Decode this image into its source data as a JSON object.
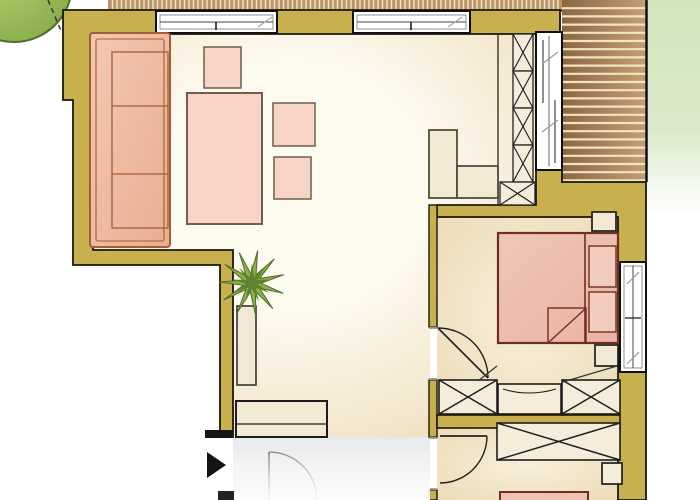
{
  "meta": {
    "type": "floor-plan",
    "rooms": [
      "living-room",
      "bedroom",
      "second-room",
      "entrance-hall",
      "balcony-terrace"
    ]
  },
  "palette": {
    "wall": "#c7b04d",
    "wallStroke": "#1b170a",
    "stripPlank": "#bd9468",
    "stripGap": "#f2e5cc",
    "deckGap": "#f2e3c6",
    "deckA": "#8a6642",
    "deckB": "#c79e72",
    "floorLight": "#fdfaf0",
    "floorWarm": "#efdebd",
    "bedFloorLight": "#f8efda",
    "bedFloorWarm": "#ecdbb8",
    "hallA": "#e8eaec",
    "hallB": "#f4f5f6",
    "sofaA": "#f3c9b4",
    "sofaB": "#e9ad90",
    "sofaStroke": "#a55d35",
    "tableFill": "#f7d4c5",
    "tableStroke": "#6e5e4b",
    "cabFill": "#f2e9d5",
    "cabStroke": "#514b3b",
    "wardrobeFill": "#f5edd9",
    "bedA": "#f0c6b9",
    "bedB": "#e9b3a3",
    "bedFill": "#edc1b4",
    "bedStroke": "#6f2f1f",
    "pillow": "#f3ccc0",
    "doorGray": "#8a8a8a",
    "jambGray": "#8f8f8f",
    "gardenGreen": "#cfe3b9",
    "treeA": "#b3cf6d",
    "treeB": "#86a948",
    "treeStroke": "#4f6c28",
    "green1": "#8cb04b",
    "green2": "#5d8430"
  },
  "elements": [
    {
      "t": "rect",
      "n": "garden-green",
      "x": 647,
      "y": 0,
      "w": 53,
      "h": 215,
      "f": "url(#gGreen)"
    },
    {
      "t": "circle",
      "n": "tree-canopy",
      "cx": 14,
      "cy": -16,
      "r": 58,
      "f": "url(#gTree)",
      "s": "$treeStroke",
      "sw": 2
    },
    {
      "t": "line",
      "n": "roof-overhang-dashed-line",
      "x1": 48,
      "y1": 0,
      "x2": 62,
      "y2": 33,
      "s": "#333333",
      "sw": 1.5,
      "dash": "5,4"
    },
    {
      "t": "poly",
      "n": "living-room-floor",
      "pts": "93,34 536,34 536,205 430,205 430,437 233,437 233,250 93,250",
      "f": "url(#gFloorLiving)"
    },
    {
      "t": "rect",
      "n": "bedroom-floor",
      "x": 437,
      "y": 217,
      "w": 181,
      "h": 198,
      "f": "url(#gFloorBed)"
    },
    {
      "t": "rect",
      "n": "second-room-floor",
      "x": 437,
      "y": 428,
      "w": 181,
      "h": 72,
      "f": "url(#gFloorBed)"
    },
    {
      "t": "rect",
      "n": "entrance-hall-floor",
      "x": 233,
      "y": 437,
      "w": 197,
      "h": 63,
      "f": "url(#gHall)"
    },
    {
      "t": "vstripes",
      "n": "terrace-deck-strip",
      "x": 108,
      "y": 0,
      "w": 454,
      "h": 10,
      "step": 4.5,
      "f": "$stripPlank",
      "gap": "$stripGap",
      "gsw": 1.4
    },
    {
      "t": "line",
      "n": "deck-strip-edge",
      "x1": 108,
      "y1": 10.8,
      "x2": 562,
      "y2": 10.8,
      "s": "#1c1c14",
      "sw": 1.6
    },
    {
      "t": "hstripes",
      "n": "balcony-deck",
      "x": 562,
      "y": 0,
      "w": 84,
      "h": 182,
      "step": 8.2,
      "f": "url(#gDeck)",
      "gap": "$deckGap",
      "gsw": 2.2
    },
    {
      "t": "line",
      "n": "balcony-edge-right",
      "x1": 646.5,
      "y1": 0,
      "x2": 646.5,
      "y2": 182,
      "s": "#111111",
      "sw": 2.5
    },
    {
      "t": "line",
      "n": "balcony-edge-bottom",
      "x1": 562,
      "y1": 182.5,
      "x2": 646,
      "y2": 182.5,
      "s": "#111111",
      "sw": 2
    },
    {
      "t": "poly",
      "n": "outer-wall-left",
      "pts": "63,10 560,10 560,34 93,34 93,250 233,250 233,437 220,437 220,265 73,265 73,100 63,100",
      "f": "$wall",
      "s": "$wallStroke",
      "sw": 1.8
    },
    {
      "t": "poly",
      "n": "outer-wall-right",
      "pts": "536,170 562,170 562,182 646,182 646,500 618,500 618,217 437,217 437,205 536,205",
      "f": "$wall",
      "s": "$wallStroke",
      "sw": 1.8
    },
    {
      "t": "rect",
      "n": "partition-wall-upper",
      "x": 429,
      "y": 205,
      "w": 8,
      "h": 122,
      "f": "$wall",
      "s": "$wallStroke",
      "sw": 1.4
    },
    {
      "t": "rect",
      "n": "partition-wall-mid",
      "x": 429,
      "y": 380,
      "w": 8,
      "h": 57,
      "f": "$wall",
      "s": "$wallStroke",
      "sw": 1.4
    },
    {
      "t": "rect",
      "n": "partition-wall-lower",
      "x": 429,
      "y": 490,
      "w": 8,
      "h": 10,
      "f": "$wall",
      "s": "$wallStroke",
      "sw": 1.4
    },
    {
      "t": "rect",
      "n": "bedrooms-divider-wall",
      "x": 437,
      "y": 415,
      "w": 183,
      "h": 13,
      "f": "$wall",
      "s": "$wallStroke",
      "sw": 1.6
    },
    {
      "t": "rect",
      "n": "wall-end-cap",
      "x": 205,
      "y": 430,
      "w": 28,
      "h": 8,
      "f": "#161616"
    },
    {
      "t": "line",
      "n": "door-jamb-1",
      "x1": 429,
      "y1": 327.8,
      "x2": 437,
      "y2": 327.8,
      "s": "$jambGray",
      "sw": 2
    },
    {
      "t": "line",
      "n": "door-jamb-2",
      "x1": 429,
      "y1": 379.2,
      "x2": 437,
      "y2": 379.2,
      "s": "$jambGray",
      "sw": 2
    },
    {
      "t": "line",
      "n": "door-jamb-3",
      "x1": 429,
      "y1": 437.8,
      "x2": 437,
      "y2": 437.8,
      "s": "$jambGray",
      "sw": 2
    },
    {
      "t": "line",
      "n": "door-jamb-4",
      "x1": 429,
      "y1": 489.2,
      "x2": 437,
      "y2": 489.2,
      "s": "$jambGray",
      "sw": 2
    },
    {
      "t": "line",
      "n": "column-guide-line",
      "x1": 498,
      "y1": 34,
      "x2": 498,
      "y2": 205,
      "s": "#3a3428",
      "sw": 1.4
    },
    {
      "t": "xbox",
      "n": "shelf-column-cell-1",
      "x": 513,
      "y": 34,
      "w": 20,
      "h": 37,
      "f": "$wardrobeFill",
      "s": "#222222",
      "sw": 1.3
    },
    {
      "t": "xbox",
      "n": "shelf-column-cell-2",
      "x": 513,
      "y": 71,
      "w": 20,
      "h": 37,
      "f": "$wardrobeFill",
      "s": "#222222",
      "sw": 1.3
    },
    {
      "t": "xbox",
      "n": "shelf-column-cell-3",
      "x": 513,
      "y": 108,
      "w": 20,
      "h": 37,
      "f": "$wardrobeFill",
      "s": "#222222",
      "sw": 1.3
    },
    {
      "t": "xbox",
      "n": "shelf-column-cell-4",
      "x": 513,
      "y": 145,
      "w": 20,
      "h": 37,
      "f": "$wardrobeFill",
      "s": "#222222",
      "sw": 1.3
    },
    {
      "t": "xbox",
      "n": "shelf-column-base",
      "x": 500,
      "y": 182,
      "w": 35,
      "h": 23,
      "f": "$wardrobeFill",
      "s": "#222222",
      "sw": 1.3
    },
    {
      "t": "rect",
      "n": "balcony-sliding-door",
      "x": 536,
      "y": 32,
      "w": 26,
      "h": 138,
      "f": "#ffffff",
      "s": "#101010",
      "sw": 2
    },
    {
      "t": "line",
      "n": "sliding-door-rail",
      "x1": 549,
      "y1": 36,
      "x2": 549,
      "y2": 166,
      "s": "#666666",
      "sw": 1
    },
    {
      "t": "line",
      "n": "sliding-panel-1",
      "x1": 543,
      "y1": 40,
      "x2": 543,
      "y2": 103,
      "s": "#444444",
      "sw": 1.2
    },
    {
      "t": "line",
      "n": "sliding-panel-2",
      "x1": 555,
      "y1": 100,
      "x2": 555,
      "y2": 163,
      "s": "#444444",
      "sw": 1.2
    },
    {
      "t": "line",
      "n": "slide-arrow-1",
      "x1": 558,
      "y1": 52,
      "x2": 542,
      "y2": 64,
      "s": "#999999",
      "sw": 1.2
    },
    {
      "t": "line",
      "n": "slide-arrow-2",
      "x1": 558,
      "y1": 120,
      "x2": 542,
      "y2": 132,
      "s": "#999999",
      "sw": 1.2
    },
    {
      "t": "rect",
      "n": "window-1",
      "x": 156,
      "y": 11,
      "w": 121,
      "h": 22,
      "f": "#ffffff",
      "s": "#101010",
      "sw": 2
    },
    {
      "t": "rect",
      "n": "window-1-inner",
      "x": 160,
      "y": 15,
      "w": 113,
      "h": 14,
      "f": "none",
      "s": "#777777",
      "sw": 0.8
    },
    {
      "t": "line",
      "n": "window-1-mid",
      "x1": 160,
      "y1": 22,
      "x2": 273,
      "y2": 22,
      "s": "#444444",
      "sw": 1
    },
    {
      "t": "line",
      "n": "window-1-tick",
      "x1": 216,
      "y1": 22,
      "x2": 216,
      "y2": 30,
      "s": "#111111",
      "sw": 1.5
    },
    {
      "t": "line",
      "n": "window-1-arrow",
      "x1": 258,
      "y1": 27,
      "x2": 272,
      "y2": 17,
      "s": "#aaaaaa",
      "sw": 1.2
    },
    {
      "t": "rect",
      "n": "window-2",
      "x": 353,
      "y": 11,
      "w": 117,
      "h": 22,
      "f": "#ffffff",
      "s": "#101010",
      "sw": 2
    },
    {
      "t": "rect",
      "n": "window-2-inner",
      "x": 357,
      "y": 15,
      "w": 109,
      "h": 14,
      "f": "none",
      "s": "#777777",
      "sw": 0.8
    },
    {
      "t": "line",
      "n": "window-2-mid",
      "x1": 357,
      "y1": 22,
      "x2": 466,
      "y2": 22,
      "s": "#444444",
      "sw": 1
    },
    {
      "t": "line",
      "n": "window-2-tick",
      "x1": 411,
      "y1": 22,
      "x2": 411,
      "y2": 30,
      "s": "#111111",
      "sw": 1.5
    },
    {
      "t": "line",
      "n": "window-2-arrow",
      "x1": 448,
      "y1": 27,
      "x2": 462,
      "y2": 17,
      "s": "#aaaaaa",
      "sw": 1.2
    },
    {
      "t": "rect",
      "n": "sofa",
      "x": 90,
      "y": 33,
      "w": 80,
      "h": 214,
      "rx": 3,
      "f": "url(#gSofa)",
      "s": "$sofaStroke",
      "sw": 2
    },
    {
      "t": "rect",
      "n": "sofa-inner-frame",
      "x": 96,
      "y": 39,
      "w": 68,
      "h": 202,
      "rx": 2,
      "f": "none",
      "s": "$sofaStroke",
      "sw": 1.1
    },
    {
      "t": "rect",
      "n": "sofa-cushions",
      "x": 112,
      "y": 52,
      "w": 56,
      "h": 176,
      "f": "none",
      "s": "$sofaStroke",
      "sw": 1.3
    },
    {
      "t": "line",
      "n": "sofa-cushion-divider-1",
      "x1": 112,
      "y1": 106,
      "x2": 168,
      "y2": 106,
      "s": "$sofaStroke",
      "sw": 1.3
    },
    {
      "t": "line",
      "n": "sofa-cushion-divider-2",
      "x1": 112,
      "y1": 174,
      "x2": 168,
      "y2": 174,
      "s": "$sofaStroke",
      "sw": 1.3
    },
    {
      "t": "rect",
      "n": "dining-table",
      "x": 187,
      "y": 93,
      "w": 75,
      "h": 131,
      "f": "$tableFill",
      "s": "$tableStroke",
      "sw": 2
    },
    {
      "t": "rect",
      "n": "chair-top",
      "x": 204,
      "y": 47,
      "w": 37,
      "h": 41,
      "f": "$tableFill",
      "s": "$tableStroke",
      "sw": 1.5
    },
    {
      "t": "rect",
      "n": "chair-right-1",
      "x": 273,
      "y": 103,
      "w": 42,
      "h": 43,
      "f": "$tableFill",
      "s": "$tableStroke",
      "sw": 1.5
    },
    {
      "t": "rect",
      "n": "chair-right-2",
      "x": 274,
      "y": 157,
      "w": 37,
      "h": 42,
      "f": "$tableFill",
      "s": "$tableStroke",
      "sw": 1.5
    },
    {
      "t": "rect",
      "n": "plant-pot",
      "x": 237,
      "y": 306,
      "w": 19,
      "h": 79,
      "f": "$cabFill",
      "s": "#333333",
      "sw": 1.6
    },
    {
      "t": "star",
      "n": "plant-leaves-outer",
      "cx": 252,
      "cy": 283,
      "ro": 33,
      "ri": 9,
      "npts": 11,
      "rot": 10,
      "f": "$green1",
      "s": "$treeStroke",
      "sw": 1
    },
    {
      "t": "star",
      "n": "plant-leaves-inner",
      "cx": 252,
      "cy": 283,
      "ro": 20,
      "ri": 6,
      "npts": 9,
      "rot": 40,
      "f": "$green2"
    },
    {
      "t": "rect",
      "n": "entry-bench",
      "x": 236,
      "y": 401,
      "w": 91,
      "h": 36,
      "f": "$cabFill",
      "s": "#1d1d1d",
      "sw": 2
    },
    {
      "t": "line",
      "n": "entry-bench-edge",
      "x1": 237,
      "y1": 424,
      "x2": 326,
      "y2": 424,
      "s": "#1d1d1d",
      "sw": 1.2
    },
    {
      "t": "rect",
      "n": "kitchen-unit-tall",
      "x": 429,
      "y": 130,
      "w": 28,
      "h": 68,
      "f": "$cabFill",
      "s": "$cabStroke",
      "sw": 1.8
    },
    {
      "t": "rect",
      "n": "kitchen-unit-low",
      "x": 457,
      "y": 166,
      "w": 41,
      "h": 32,
      "f": "$cabFill",
      "s": "$cabStroke",
      "sw": 1.8
    },
    {
      "t": "rect",
      "n": "nightstand-top",
      "x": 592,
      "y": 212,
      "w": 24,
      "h": 19,
      "f": "$cabFill",
      "s": "#1d1d1d",
      "sw": 1.7
    },
    {
      "t": "rect",
      "n": "nightstand-bottom",
      "x": 595,
      "y": 345,
      "w": 23,
      "h": 21,
      "f": "$cabFill",
      "s": "#1d1d1d",
      "sw": 1.7
    },
    {
      "t": "rect",
      "n": "double-bed",
      "x": 498,
      "y": 233,
      "w": 120,
      "h": 110,
      "f": "url(#gBed)",
      "s": "$bedStroke",
      "sw": 2.2
    },
    {
      "t": "line",
      "n": "bed-headboard-line",
      "x1": 585,
      "y1": 233,
      "x2": 585,
      "y2": 343,
      "s": "$bedStroke",
      "sw": 1.6
    },
    {
      "t": "rect",
      "n": "pillow-1",
      "x": 589,
      "y": 246,
      "w": 27,
      "h": 41,
      "f": "$pillow",
      "s": "$bedStroke",
      "sw": 1.4
    },
    {
      "t": "rect",
      "n": "pillow-2",
      "x": 589,
      "y": 292,
      "w": 27,
      "h": 40,
      "f": "$pillow",
      "s": "$bedStroke",
      "sw": 1.4
    },
    {
      "t": "rect",
      "n": "duvet-fold",
      "x": 548,
      "y": 308,
      "w": 38,
      "h": 35,
      "f": "none",
      "s": "$bedStroke",
      "sw": 1.4
    },
    {
      "t": "line",
      "n": "duvet-fold-diagonal",
      "x1": 549,
      "y1": 342,
      "x2": 585,
      "y2": 309,
      "s": "$bedStroke",
      "sw": 1.4
    },
    {
      "t": "path",
      "n": "bedroom-door-arc",
      "d": "M 438,328 A 50,50 0 0 1 488,378",
      "f": "none",
      "s": "#222222",
      "sw": 1.4
    },
    {
      "t": "line",
      "n": "bedroom-door-leaf",
      "x1": 438,
      "y1": 328,
      "x2": 488,
      "y2": 378,
      "s": "#222222",
      "sw": 1.6
    },
    {
      "t": "xbox",
      "n": "wardrobe-left",
      "x": 439,
      "y": 380,
      "w": 58,
      "h": 34,
      "f": "$wardrobeFill",
      "s": "#1d1d1d",
      "sw": 1.6
    },
    {
      "t": "rect",
      "n": "dresser",
      "x": 498,
      "y": 384,
      "w": 63,
      "h": 30,
      "f": "$wardrobeFill",
      "s": "#1d1d1d",
      "sw": 1.6
    },
    {
      "t": "path",
      "n": "dresser-front-curve",
      "d": "M 503,389 Q 529,397 556,389",
      "f": "none",
      "s": "#1d1d1d",
      "sw": 1.1
    },
    {
      "t": "xbox",
      "n": "wardrobe-right",
      "x": 562,
      "y": 380,
      "w": 58,
      "h": 34,
      "f": "$wardrobeFill",
      "s": "#1d1d1d",
      "sw": 1.6
    },
    {
      "t": "line",
      "n": "closet-swing-line-1",
      "x1": 478,
      "y1": 381,
      "x2": 497,
      "y2": 366,
      "s": "#333333",
      "sw": 1.2
    },
    {
      "t": "line",
      "n": "closet-swing-line-2",
      "x1": 563,
      "y1": 382,
      "x2": 617,
      "y2": 366,
      "s": "#333333",
      "sw": 1.2
    },
    {
      "t": "rect",
      "n": "window-3",
      "x": 620,
      "y": 262,
      "w": 26,
      "h": 110,
      "f": "#ffffff",
      "s": "#101010",
      "sw": 2
    },
    {
      "t": "rect",
      "n": "window-3-inner",
      "x": 624,
      "y": 266,
      "w": 18,
      "h": 102,
      "f": "none",
      "s": "#777777",
      "sw": 0.8
    },
    {
      "t": "line",
      "n": "window-3-mid",
      "x1": 633,
      "y1": 266,
      "x2": 633,
      "y2": 368,
      "s": "#444444",
      "sw": 1
    },
    {
      "t": "line",
      "n": "window-3-tick",
      "x1": 625,
      "y1": 318,
      "x2": 641,
      "y2": 318,
      "s": "#111111",
      "sw": 1.2
    },
    {
      "t": "line",
      "n": "window-3-arrow-1",
      "x1": 639,
      "y1": 272,
      "x2": 627,
      "y2": 284,
      "s": "#999999",
      "sw": 1.2
    },
    {
      "t": "line",
      "n": "window-3-arrow-2",
      "x1": 639,
      "y1": 352,
      "x2": 627,
      "y2": 364,
      "s": "#999999",
      "sw": 1.2
    },
    {
      "t": "xbox",
      "n": "wardrobe-2",
      "x": 497,
      "y": 423,
      "w": 123,
      "h": 37,
      "f": "$wardrobeFill",
      "s": "#1d1d1d",
      "sw": 1.6
    },
    {
      "t": "rect",
      "n": "side-table-2",
      "x": 602,
      "y": 463,
      "w": 20,
      "h": 21,
      "f": "$wardrobeFill",
      "s": "#1d1d1d",
      "sw": 1.7
    },
    {
      "t": "rect",
      "n": "bed-2",
      "x": 500,
      "y": 492,
      "w": 88,
      "h": 10,
      "f": "$bedFill",
      "s": "$bedStroke",
      "sw": 2
    },
    {
      "t": "line",
      "n": "second-room-door-leaf",
      "x1": 440,
      "y1": 436,
      "x2": 487,
      "y2": 436,
      "s": "#222222",
      "sw": 1.8
    },
    {
      "t": "path",
      "n": "second-room-door-arc",
      "d": "M 487,436 A 47,47 0 0 1 440,483",
      "f": "none",
      "s": "#222222",
      "sw": 1.4
    },
    {
      "t": "line",
      "n": "entry-door-leaf",
      "x1": 269,
      "y1": 452,
      "x2": 269,
      "y2": 500,
      "s": "$doorGray",
      "sw": 1.8
    },
    {
      "t": "path",
      "n": "entry-door-arc",
      "d": "M 269,452 A 48,48 0 0 1 317,500",
      "f": "none",
      "s": "$doorGray",
      "sw": 1.4
    },
    {
      "t": "rect",
      "n": "bottom-fade",
      "x": 233,
      "y": 450,
      "w": 197,
      "h": 50,
      "f": "url(#gFadeWhite)"
    },
    {
      "t": "poly",
      "n": "entrance-arrow",
      "pts": "207,452 207,478 226,465",
      "f": "#131313"
    },
    {
      "t": "rect",
      "n": "wall-stub",
      "x": 218,
      "y": 491,
      "w": 16,
      "h": 9,
      "f": "#222222"
    }
  ]
}
